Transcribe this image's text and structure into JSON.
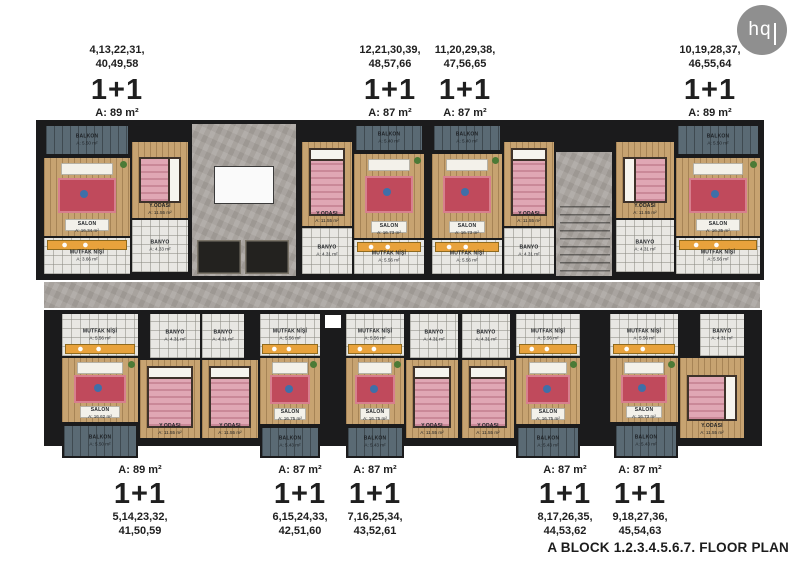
{
  "logo": {
    "text": "hq"
  },
  "caption": "A BLOCK 1.2.3.4.5.6.7. FLOOR PLAN",
  "unit_labels": {
    "top": [
      {
        "numbers": "4,13,22,31,",
        "numbers2": "40,49,58",
        "type": "1+1",
        "area": "A: 89 m²",
        "x": 117
      },
      {
        "numbers": "12,21,30,39,",
        "numbers2": "48,57,66",
        "type": "1+1",
        "area": "A: 87 m²",
        "x": 390
      },
      {
        "numbers": "11,20,29,38,",
        "numbers2": "47,56,65",
        "type": "1+1",
        "area": "A: 87 m²",
        "x": 465
      },
      {
        "numbers": "10,19,28,37,",
        "numbers2": "46,55,64",
        "type": "1+1",
        "area": "A: 89 m²",
        "x": 710
      }
    ],
    "bottom": [
      {
        "area": "A: 89 m²",
        "type": "1+1",
        "numbers": "5,14,23,32,",
        "numbers2": "41,50,59",
        "x": 140
      },
      {
        "area": "A: 87 m²",
        "type": "1+1",
        "numbers": "6,15,24,33,",
        "numbers2": "42,51,60",
        "x": 300
      },
      {
        "area": "A: 87 m²",
        "type": "1+1",
        "numbers": "7,16,25,34,",
        "numbers2": "43,52,61",
        "x": 375
      },
      {
        "area": "A: 87 m²",
        "type": "1+1",
        "numbers": "8,17,26,35,",
        "numbers2": "44,53,62",
        "x": 565
      },
      {
        "area": "A: 87 m²",
        "type": "1+1",
        "numbers": "9,18,27,36,",
        "numbers2": "45,54,63",
        "x": 640
      }
    ]
  },
  "colors": {
    "wall": "#1b1b1c",
    "wood": "#c7a371",
    "balcony": "#5a6a74",
    "marble": "#a8a39e",
    "tile": "#e8e7e3",
    "bed": "#e0a7b4",
    "rug": "#c04a5c",
    "counter": "#e8a23c"
  },
  "floorplan": {
    "walls": [
      [
        36,
        120,
        728,
        160
      ],
      [
        44,
        310,
        718,
        136
      ]
    ],
    "rooms": [
      {
        "kind": "marble",
        "name": "core-hall",
        "r": [
          192,
          124,
          104,
          152
        ]
      },
      {
        "kind": "stairvoid",
        "name": "stair-void",
        "r": [
          214,
          166,
          60,
          38
        ]
      },
      {
        "kind": "elevator",
        "name": "elevator",
        "r": [
          197,
          240,
          44,
          34
        ]
      },
      {
        "kind": "elevator",
        "name": "elevator",
        "r": [
          245,
          240,
          44,
          34
        ]
      },
      {
        "kind": "marble",
        "name": "stair-hall",
        "r": [
          556,
          152,
          56,
          124
        ]
      },
      {
        "kind": "stairs",
        "name": "stairs",
        "r": [
          560,
          206,
          50,
          68
        ]
      },
      {
        "kind": "marble",
        "name": "corridor",
        "r": [
          44,
          282,
          716,
          26
        ]
      },
      {
        "kind": "balcony",
        "r": [
          44,
          124,
          86,
          32
        ],
        "label": "BALKON",
        "area": "A: 5.50 m²"
      },
      {
        "kind": "salon",
        "r": [
          44,
          158,
          86,
          78
        ],
        "label": "SALON",
        "area": "A: 16.34 m²"
      },
      {
        "kind": "bedroom",
        "r": [
          132,
          142,
          56,
          76
        ],
        "label": "Y.ODASI",
        "area": "A: 11.55 m²",
        "bed": "h-r"
      },
      {
        "kind": "banyo",
        "r": [
          132,
          220,
          56,
          52
        ],
        "label": "BANYO",
        "area": "A: 4.33 m²"
      },
      {
        "kind": "kitchen",
        "r": [
          44,
          238,
          86,
          36
        ],
        "label": "MUTFAK NİŞİ",
        "area": "A: 3.66 m²",
        "counter": "top"
      },
      {
        "kind": "bedroom",
        "r": [
          302,
          142,
          50,
          84
        ],
        "label": "Y.ODASI",
        "area": "A: 11.55 m²",
        "bed": "v"
      },
      {
        "kind": "banyo",
        "r": [
          302,
          228,
          50,
          46
        ],
        "label": "BANYO",
        "area": "A: 4.31 m²"
      },
      {
        "kind": "balcony",
        "r": [
          354,
          124,
          70,
          28
        ],
        "label": "BALKON",
        "area": "A: 5.40 m²"
      },
      {
        "kind": "salon",
        "r": [
          354,
          154,
          70,
          84
        ],
        "label": "SALON",
        "area": "A: 16.73 m²"
      },
      {
        "kind": "kitchen",
        "r": [
          354,
          240,
          70,
          34
        ],
        "label": "MUTFAK NİŞİ",
        "area": "A: 5.56 m²",
        "counter": "top"
      },
      {
        "kind": "balcony",
        "r": [
          432,
          124,
          70,
          28
        ],
        "label": "BALKON",
        "area": "A: 5.40 m²"
      },
      {
        "kind": "salon",
        "r": [
          432,
          154,
          70,
          84
        ],
        "label": "SALON",
        "area": "A: 16.73 m²"
      },
      {
        "kind": "kitchen",
        "r": [
          432,
          240,
          70,
          34
        ],
        "label": "MUTFAK NİŞİ",
        "area": "A: 5.56 m²",
        "counter": "top"
      },
      {
        "kind": "bedroom",
        "r": [
          504,
          142,
          50,
          84
        ],
        "label": "Y.ODASI",
        "area": "A: 11.55 m²",
        "bed": "v"
      },
      {
        "kind": "banyo",
        "r": [
          504,
          228,
          50,
          46
        ],
        "label": "BANYO",
        "area": "A: 4.31 m²"
      },
      {
        "kind": "bedroom",
        "r": [
          616,
          142,
          58,
          76
        ],
        "label": "Y.ODASI",
        "area": "A: 11.55 m²",
        "bed": "h-l"
      },
      {
        "kind": "banyo",
        "r": [
          616,
          220,
          58,
          52
        ],
        "label": "BANYO",
        "area": "A: 4.31 m²"
      },
      {
        "kind": "balcony",
        "r": [
          676,
          124,
          84,
          32
        ],
        "label": "BALKON",
        "area": "A: 5.50 m²"
      },
      {
        "kind": "salon",
        "r": [
          676,
          158,
          84,
          78
        ],
        "label": "SALON",
        "area": "A: 16.35 m²"
      },
      {
        "kind": "kitchen",
        "r": [
          676,
          238,
          84,
          36
        ],
        "label": "MUTFAK NİŞİ",
        "area": "A: 5.56 m²",
        "counter": "top"
      },
      {
        "kind": "kitchen",
        "r": [
          62,
          314,
          76,
          42
        ],
        "label": "MUTFAK NİŞİ",
        "area": "A: 5.56 m²",
        "counter": "bottom"
      },
      {
        "kind": "banyo",
        "r": [
          150,
          314,
          50,
          44
        ],
        "label": "BANYO",
        "area": "A: 4.31 m²"
      },
      {
        "kind": "salon",
        "r": [
          62,
          358,
          76,
          64
        ],
        "label": "SALON",
        "area": "A: 16.62 m²"
      },
      {
        "kind": "bedroom",
        "r": [
          140,
          360,
          60,
          78
        ],
        "label": "Y.ODASI",
        "area": "A: 11.55 m²",
        "bed": "v"
      },
      {
        "kind": "balcony",
        "r": [
          62,
          424,
          76,
          34
        ],
        "label": "BALKON",
        "area": "A: 5.50 m²"
      },
      {
        "kind": "banyo",
        "r": [
          202,
          314,
          42,
          44
        ],
        "label": "BANYO",
        "area": "A: 4.31 m²"
      },
      {
        "kind": "bedroom",
        "r": [
          202,
          360,
          56,
          78
        ],
        "label": "Y.ODASI",
        "area": "A: 11.55 m²",
        "bed": "v"
      },
      {
        "kind": "kitchen",
        "r": [
          260,
          314,
          60,
          42
        ],
        "label": "MUTFAK NİŞİ",
        "area": "A: 5.56 m²",
        "counter": "bottom"
      },
      {
        "kind": "salon",
        "r": [
          260,
          358,
          60,
          66
        ],
        "label": "SALON",
        "area": "A: 16.75 m²"
      },
      {
        "kind": "balcony",
        "r": [
          260,
          426,
          60,
          32
        ],
        "label": "BALKON",
        "area": "A: 5.43 m²"
      },
      {
        "kind": "shaft",
        "name": "shaft",
        "r": [
          322,
          312,
          22,
          132
        ]
      },
      {
        "kind": "kitchen",
        "r": [
          346,
          314,
          58,
          42
        ],
        "label": "MUTFAK NİŞİ",
        "area": "A: 5.56 m²",
        "counter": "bottom"
      },
      {
        "kind": "salon",
        "r": [
          346,
          358,
          58,
          66
        ],
        "label": "SALON",
        "area": "A: 16.75 m²"
      },
      {
        "kind": "balcony",
        "r": [
          346,
          426,
          58,
          32
        ],
        "label": "BALKON",
        "area": "A: 5.43 m²"
      },
      {
        "kind": "bedroom",
        "r": [
          406,
          360,
          52,
          78
        ],
        "label": "Y.ODASI",
        "area": "A: 11.55 m²",
        "bed": "v"
      },
      {
        "kind": "banyo",
        "r": [
          410,
          314,
          48,
          44
        ],
        "label": "BANYO",
        "area": "A: 4.31 m²"
      },
      {
        "kind": "banyo",
        "r": [
          462,
          314,
          48,
          44
        ],
        "label": "BANYO",
        "area": "A: 4.31 m²"
      },
      {
        "kind": "bedroom",
        "r": [
          462,
          360,
          52,
          78
        ],
        "label": "Y.ODASI",
        "area": "A: 11.55 m²",
        "bed": "v"
      },
      {
        "kind": "kitchen",
        "r": [
          516,
          314,
          64,
          42
        ],
        "label": "MUTFAK NİŞİ",
        "area": "A: 5.56 m²",
        "counter": "bottom"
      },
      {
        "kind": "salon",
        "r": [
          516,
          358,
          64,
          66
        ],
        "label": "SALON",
        "area": "A: 16.75 m²"
      },
      {
        "kind": "balcony",
        "r": [
          516,
          426,
          64,
          32
        ],
        "label": "BALKON",
        "area": "A: 5.43 m²"
      },
      {
        "kind": "kitchen",
        "r": [
          610,
          314,
          68,
          42
        ],
        "label": "MUTFAK NİŞİ",
        "area": "A: 5.56 m²",
        "counter": "bottom"
      },
      {
        "kind": "banyo",
        "r": [
          700,
          314,
          44,
          42
        ],
        "label": "BANYO",
        "area": "A: 4.31 m²"
      },
      {
        "kind": "salon",
        "r": [
          610,
          358,
          68,
          64
        ],
        "label": "SALON",
        "area": "A: 16.73 m²"
      },
      {
        "kind": "bedroom",
        "r": [
          680,
          358,
          64,
          80
        ],
        "label": "Y.ODASI",
        "area": "A: 11.55 m²",
        "bed": "h-r"
      },
      {
        "kind": "balcony",
        "r": [
          614,
          424,
          64,
          34
        ],
        "label": "BALKON",
        "area": "A: 5.43 m²"
      }
    ]
  }
}
